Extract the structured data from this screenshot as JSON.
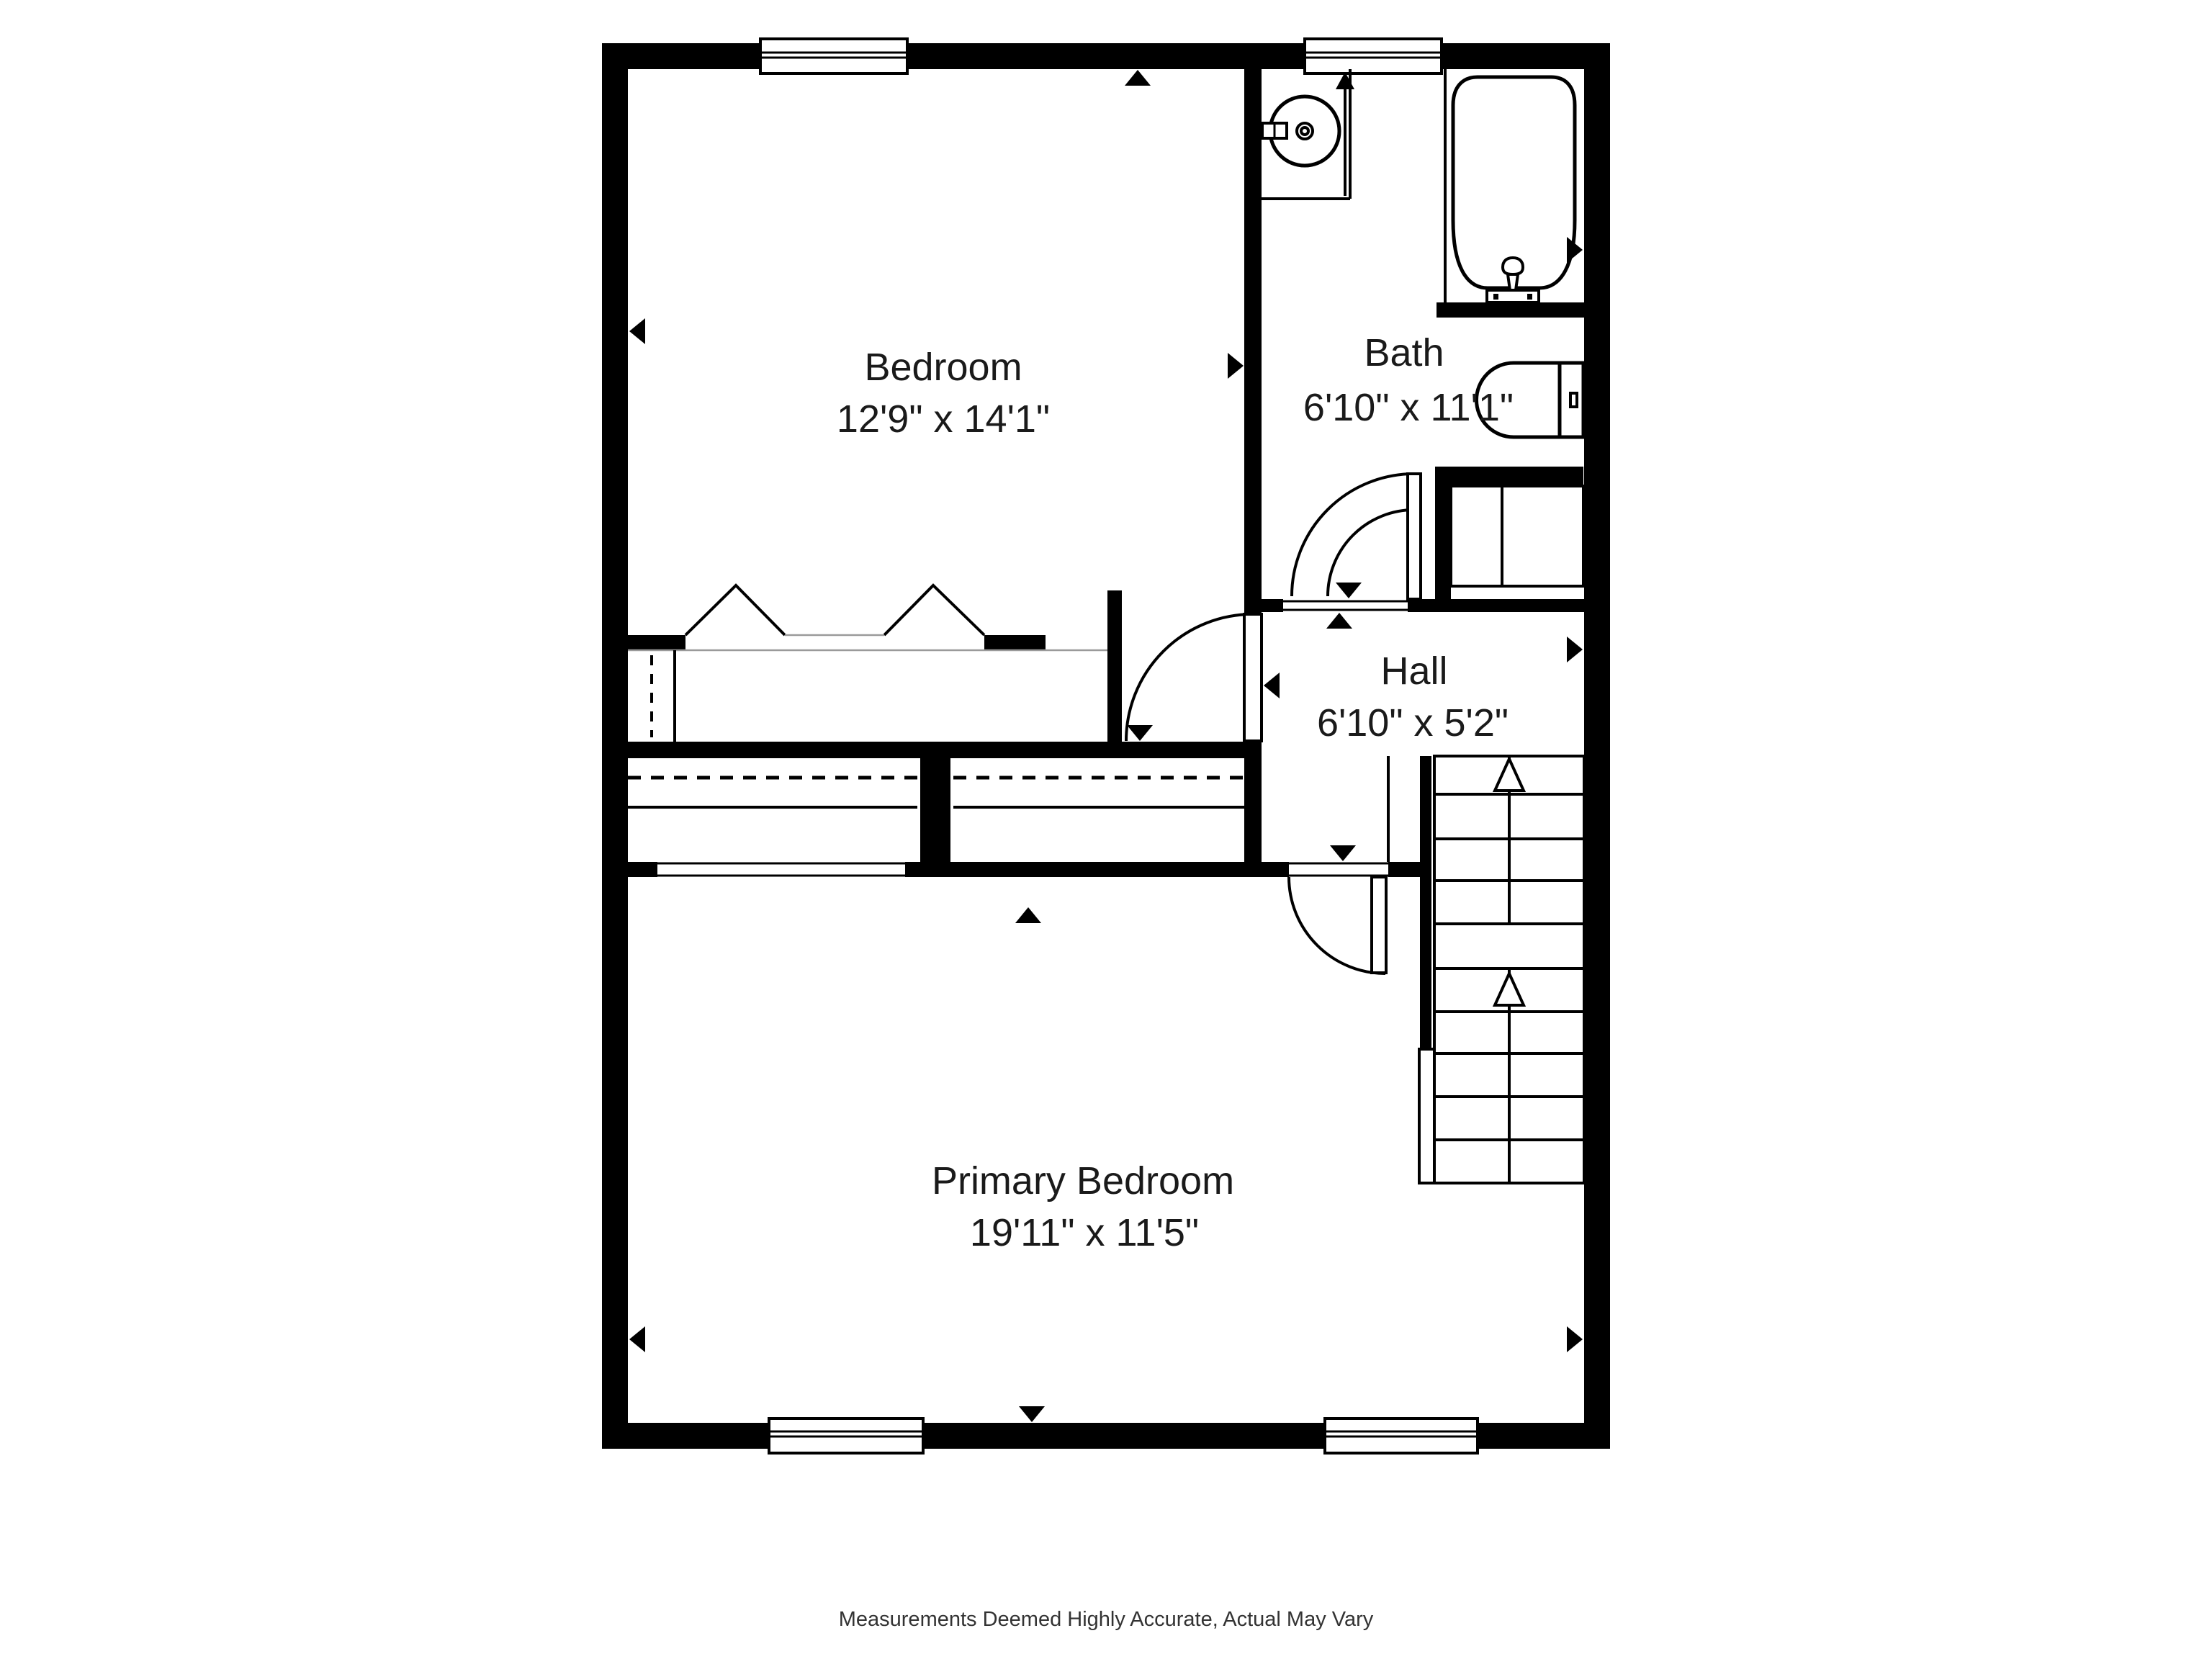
{
  "page": {
    "background": "#ffffff"
  },
  "colors": {
    "wall": "#000000",
    "line": "#000000",
    "light_line": "#9a9a9a",
    "text": "#1a1a1a",
    "background": "#ffffff"
  },
  "rooms": [
    {
      "name": "Bedroom",
      "dimensions": "12'9\" x 14'1\""
    },
    {
      "name": "Bath",
      "dimensions": "6'10\" x 11'1\""
    },
    {
      "name": "Hall",
      "dimensions": "6'10\" x 5'2\""
    },
    {
      "name": "Primary Bedroom",
      "dimensions": "19'11\" x 11'5\""
    }
  ],
  "footer": {
    "disclaimer": "Measurements Deemed Highly Accurate, Actual May Vary"
  },
  "fixtures": {
    "sink_icon": "round vessel sink with faucet",
    "bathtub_icon": "freestanding bathtub with faucet",
    "toilet_icon": "toilet with tank",
    "stairs_icon": "staircase with two runs and up arrows",
    "door_icon": "door swing arc",
    "window_icon": "double-line window",
    "closet_icon": "closet with bifold doors and hanging rod",
    "wall_marker_icon": "small solid triangle wall marker"
  }
}
